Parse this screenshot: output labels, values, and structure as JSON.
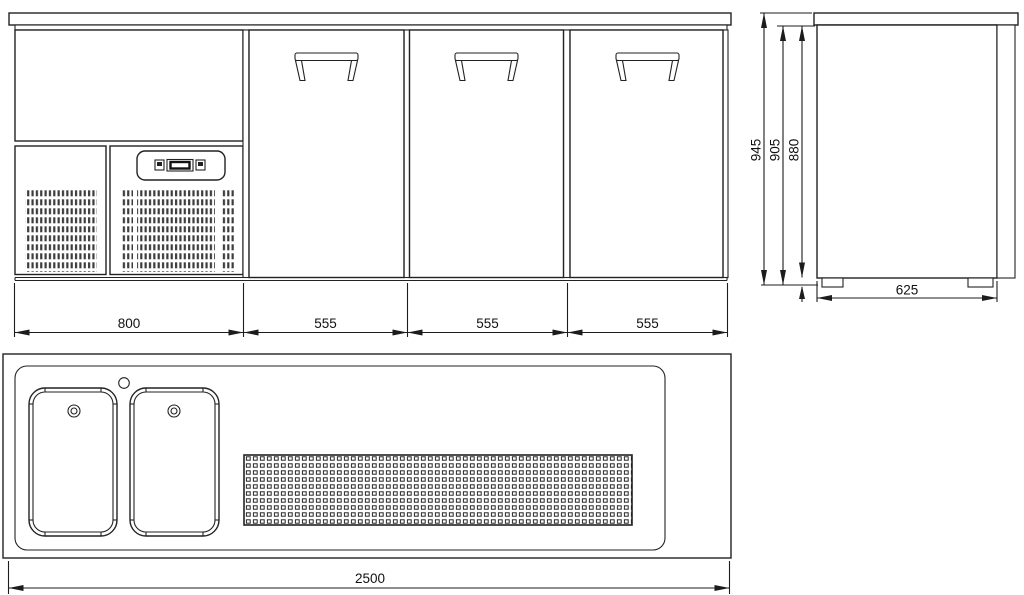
{
  "meta": {
    "drawing_type": "technical dimension drawing",
    "subject": "three-door back bar counter cooler with twin sink top",
    "units": "mm"
  },
  "colors": {
    "line": "#222222",
    "background": "#ffffff",
    "grille_fill": "#3c3c3c"
  },
  "views": {
    "front": {
      "label": "front-elevation",
      "dims": {
        "left_section": "800",
        "door_1": "555",
        "door_2": "555",
        "door_3": "555"
      }
    },
    "side": {
      "label": "side-elevation",
      "dims": {
        "overall_height": "945",
        "height_excl_counter": "905",
        "body_height": "880",
        "depth": "625"
      }
    },
    "plan": {
      "label": "top-plan",
      "dims": {
        "overall_width": "2500"
      }
    }
  }
}
